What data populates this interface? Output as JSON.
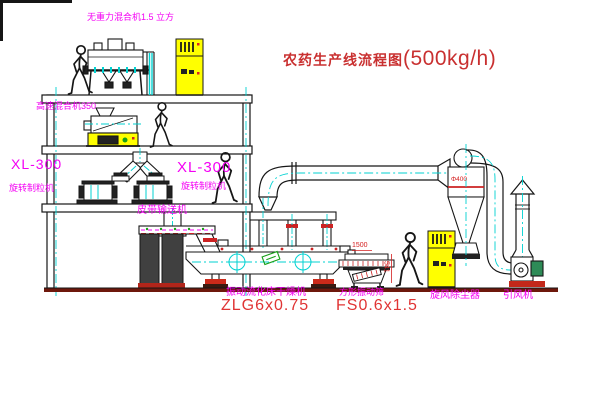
{
  "title": {
    "text": "农药生产线流程图",
    "capacity": "(500kg/h)"
  },
  "labels": {
    "top_mixer": "无重力混合机1.5 立方",
    "high_speed_mixer": "高速混合机350",
    "granulator_left_model": "XL-300",
    "granulator_left_name": "旋转制粒机",
    "granulator_right_model": "XL-300",
    "granulator_right_name": "旋转制粒机",
    "belt_conveyor": "皮带输送机",
    "fluid_bed_dryer_name": "振动流化床干燥机",
    "fluid_bed_dryer_model": "ZLG6x0.75",
    "square_sieve_name": "方形振动筛",
    "square_sieve_model": "FS0.6x1.5",
    "cyclone_name": "旋风除尘器",
    "fan_name": "引风机"
  },
  "dimensions": {
    "sieve_width": "1500",
    "sieve_height": "541",
    "cyclone_tag": "Φ400"
  },
  "colors": {
    "label_magenta": "#f400f4",
    "title_red": "#c93030",
    "model_red": "#e03434",
    "line_black": "#161616",
    "centerline_cyan": "#00d2d2",
    "equipment_yellow": "#ffff00",
    "ground_maroon": "#6e180c",
    "accent_green": "#18a018",
    "band_red": "#cc2222"
  }
}
